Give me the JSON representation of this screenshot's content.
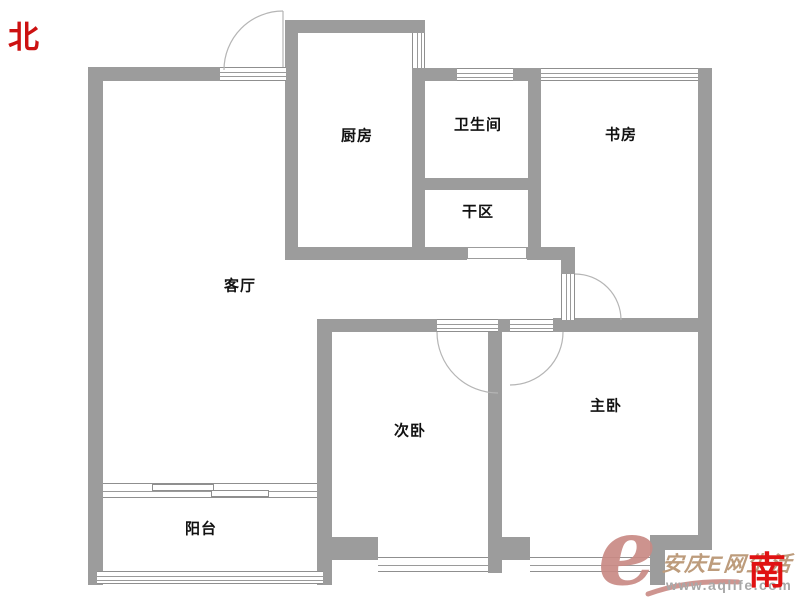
{
  "compass": {
    "north": "北",
    "south": "南"
  },
  "rooms": {
    "kitchen": "厨房",
    "bathroom": "卫生间",
    "study": "书房",
    "dry_area": "干区",
    "living_room": "客厅",
    "second_bedroom": "次卧",
    "master_bedroom": "主卧",
    "balcony": "阳台"
  },
  "watermark": {
    "logo_letter": "e",
    "site_name": "安庆E网生活",
    "url": "www.aqlife.com"
  },
  "colors": {
    "wall": "#9c9c9c",
    "window_line": "#8f8f8f",
    "door_arc": "#b5b5b5",
    "compass_red": "#cc1111",
    "watermark_rose": "#c98a84",
    "watermark_tan": "#bd9c7c",
    "watermark_gray": "#a8a8a8"
  }
}
